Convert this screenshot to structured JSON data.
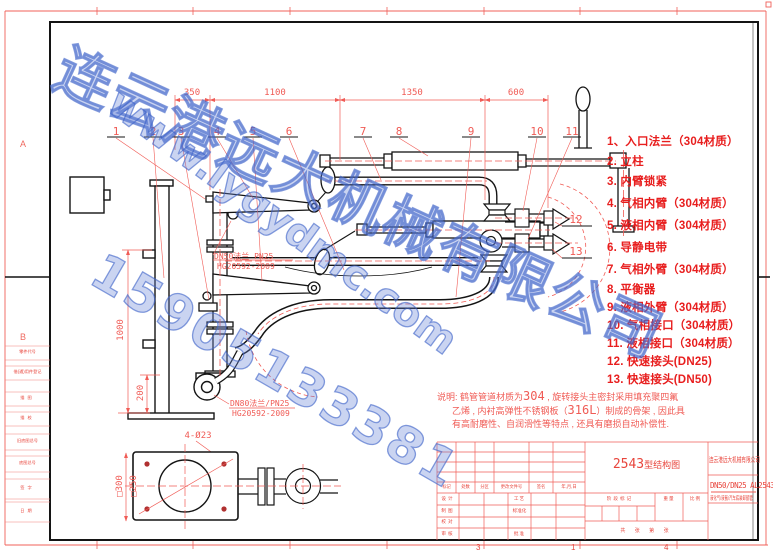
{
  "colors": {
    "accent_red": "#e8453c",
    "line_red": "#f05b55",
    "linework_black": "#141414",
    "watermark_blue": "#4e6fc8"
  },
  "sheet": {
    "zone_letter_a": "A",
    "zone_letter_b": "B",
    "fold_numbers": [
      "3",
      "1",
      "4"
    ]
  },
  "margin_labels": [
    "零件代号",
    "借(通)用件登记",
    "描图",
    "描校",
    "旧底图总号",
    "底图总号",
    "签字",
    "日期"
  ],
  "watermark": {
    "company": "连云港远大机械有限公司",
    "website": "www.lygydmc.com",
    "phone": "15905133381"
  },
  "parts": [
    "1、入口法兰（304材质）",
    "2. 立柱",
    "3. 内臂锁紧",
    "4. 气相内臂（304材质）",
    "5. 液相内臂（304材质）",
    "6. 导静电带",
    "7. 气相外臂（304材质）",
    "8. 平衡器",
    "9. 液相外臂（304材质）",
    "10. 气相接口（304材质）",
    "11. 液相接口（304材质）",
    "12. 快速接头(DN25)",
    "13. 快速接头(DN50)"
  ],
  "callouts": [
    "1",
    "2",
    "3",
    "4",
    "5",
    "6",
    "7",
    "8",
    "9",
    "10",
    "11",
    "12",
    "13"
  ],
  "dimensions": {
    "top": [
      "350",
      "1100",
      "1350",
      "600"
    ],
    "column_height": "1000",
    "base": "200",
    "detail_outer": "□300",
    "detail_bolt": "□250",
    "detail_holes": "4-Ø23"
  },
  "annotations": {
    "dn50_l1": "DN50法兰 PN25",
    "dn50_l2": "HG20592-2009",
    "dn80_l1": "DN80法兰/PN25",
    "dn80_l2": "HG20592-2009"
  },
  "notes": {
    "l1a": "说明: 鹤管管道材质为",
    "l1b": "304",
    "l1c": " , 旋转接头主密封采用填充聚四氟",
    "l2a": "乙烯 , 内衬高弹性不锈钢板（",
    "l2b": "316L",
    "l2c": "）制成的骨架 , 因此具",
    "l3": "有高耐磨性、自润滑性等特点 , 还具有磨损自动补偿性."
  },
  "title_block": {
    "title_num": "2543",
    "title_suffix": "型结构图",
    "company": "连云港远大机械有限公司",
    "drawing_no": "DN50/DN25 AL2543",
    "subtitle": "液化气/液氨/汽车底装卸鹤管",
    "rev_header": [
      "标记",
      "处数",
      "分区",
      "更改文件号",
      "签名",
      "年,月,日"
    ],
    "roles_left": [
      "设计",
      "制图",
      "校对",
      "审核"
    ],
    "roles_mid": [
      "工艺",
      "标准化",
      "批准"
    ],
    "stage": [
      "阶段标记",
      "重量",
      "比例"
    ],
    "sheet_count": "共 张 第 张"
  }
}
